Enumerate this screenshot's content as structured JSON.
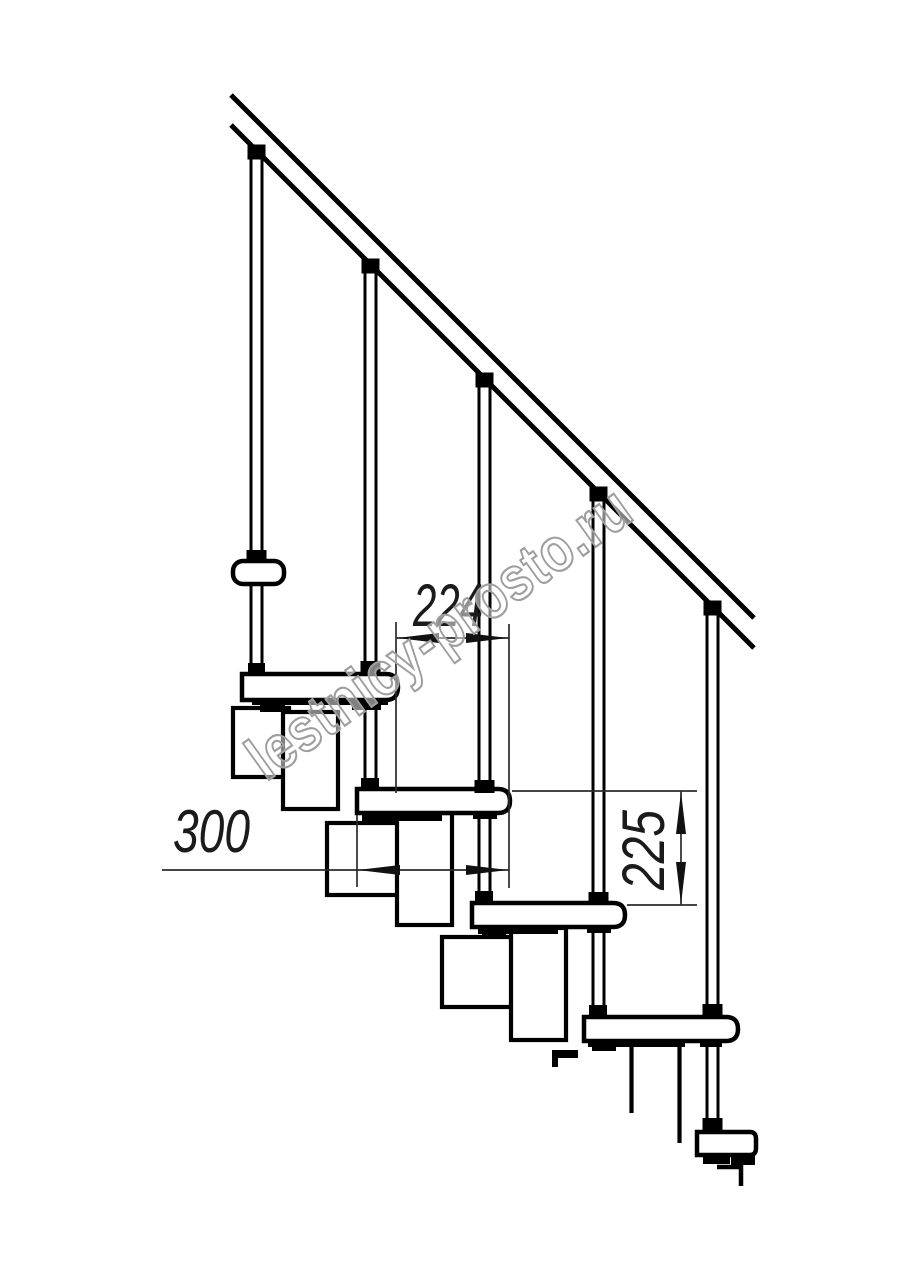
{
  "page": {
    "background": "#ffffff"
  },
  "drawing": {
    "line_color": "#000000",
    "dimension_color": "#2b2b2b",
    "labels": {
      "nose_offset": "224",
      "tread_depth": "300",
      "riser_height": "225"
    }
  },
  "watermark": {
    "text": "lestnicy-prosto.ru",
    "outline_color": "#9e9e9e",
    "fill_color": "rgba(255,255,255,0.5)"
  }
}
